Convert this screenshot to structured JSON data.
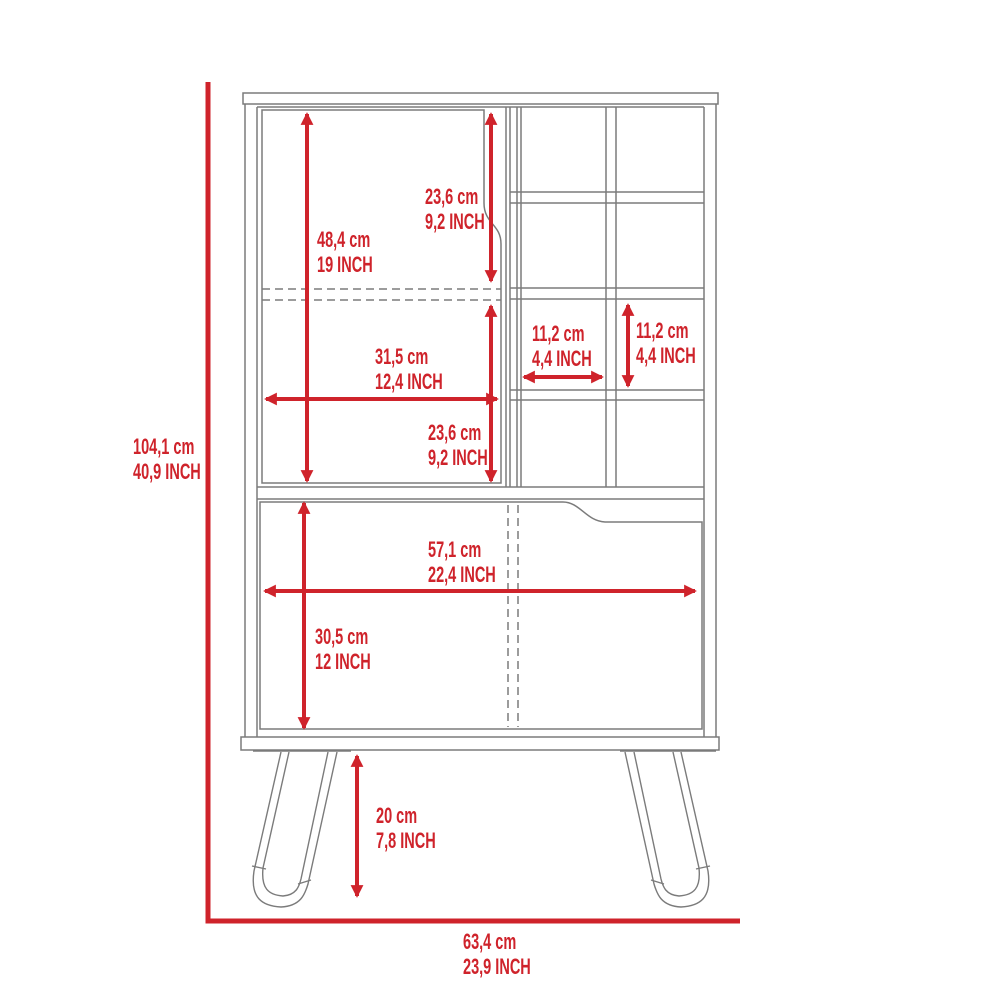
{
  "diagram": {
    "kind": "furniture dimension drawing",
    "subject": "bar cabinet with wine cubbies and hairpin legs",
    "colors": {
      "dimension_red": "#cf232b",
      "outline_gray": "#7b7b7b",
      "background": "#ffffff"
    },
    "labels": {
      "overall_height": {
        "cm": "104,1 cm",
        "inch": "40,9 INCH"
      },
      "overall_width": {
        "cm": "63,4 cm",
        "inch": "23,9 INCH"
      },
      "upper_door_height": {
        "cm": "48,4 cm",
        "inch": "19 INCH"
      },
      "upper_door_top_section": {
        "cm": "23,6 cm",
        "inch": "9,2 INCH"
      },
      "upper_door_width": {
        "cm": "31,5 cm",
        "inch": "12,4 INCH"
      },
      "upper_door_bottom_section": {
        "cm": "23,6 cm",
        "inch": "9,2 INCH"
      },
      "cubby_width": {
        "cm": "11,2 cm",
        "inch": "4,4 INCH"
      },
      "cubby_height": {
        "cm": "11,2 cm",
        "inch": "4,4 INCH"
      },
      "lower_door_width": {
        "cm": "57,1 cm",
        "inch": "22,4 INCH"
      },
      "lower_door_height": {
        "cm": "30,5 cm",
        "inch": "12 INCH"
      },
      "leg_height": {
        "cm": "20 cm",
        "inch": "7,8 INCH"
      }
    }
  }
}
